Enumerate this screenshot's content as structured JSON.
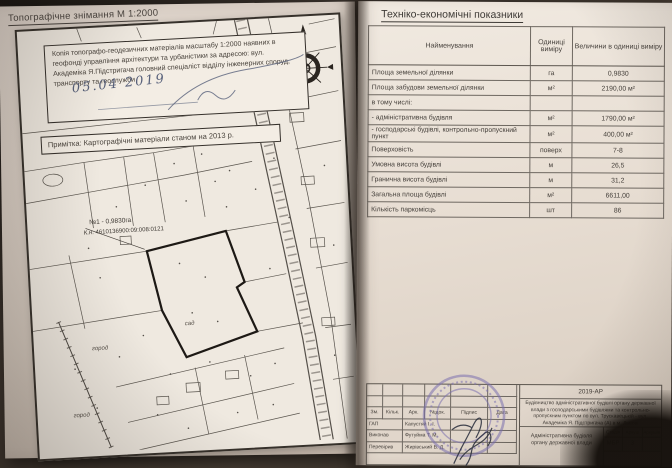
{
  "left_page": {
    "title": "Топографічне знімання М 1:2000",
    "certification": {
      "text": "Копія топографо-геодезичних матеріалів масштабу 1:2000 наявних в геофонді управління архітектури та урбаністики за адресою: вул. Академіка Я.Підстригача головний спеціаліст відділу інженерних споруд, транспорту та геослужби",
      "handwritten_date": "05.04 2019"
    },
    "note": "Примітка: Картографічні матеріали станом на 2013 р.",
    "map": {
      "north_label": "ПН",
      "parcel_label": "№1 - 0,9830га",
      "cadastral_label": "К.н. 4610136900:09:008:0121",
      "land_use_labels": [
        "город",
        "город",
        "сад"
      ]
    }
  },
  "right_page": {
    "title": "Техніко-економічні показники",
    "table": {
      "headers": [
        "Найменування",
        "Одиниці виміру",
        "Величини в одиниці виміру"
      ],
      "rows": [
        [
          "Площа земельної ділянки",
          "га",
          "0,9830"
        ],
        [
          "Площа забудови земельної ділянки",
          "м²",
          "2190,00 м²"
        ],
        [
          "в тому числі:",
          "",
          ""
        ],
        [
          "- адміністративна будівля",
          "м²",
          "1790,00 м²"
        ],
        [
          "- господарські будівлі, контрольно-пропускний пункт",
          "м²",
          "400,00 м²"
        ],
        [
          "Поверховість",
          "поверх",
          "7-8"
        ],
        [
          "Умовна висота будівлі",
          "м",
          "26,5"
        ],
        [
          "Гранична висота будівлі",
          "м",
          "31,2"
        ],
        [
          "Загальна площа будівлі",
          "м²",
          "6611,00"
        ],
        [
          "Кількість паркомісць",
          "шт",
          "86"
        ]
      ]
    },
    "title_block": {
      "project_code": "2019-АР",
      "project_name": "Будівництво адміністративної будівлі органу державної влади з господарськими будівлями та контрольно-пропускним пунктом по вул. Трускавецькій - вул. Академіка Я. Підстригача (А) в м. Львові",
      "columns": [
        "Зм.",
        "Кільк.",
        "Арк.",
        "№док.",
        "Підпис",
        "Дата"
      ],
      "roles": [
        {
          "role": "ГАП",
          "name": "Капустяй І. І."
        },
        {
          "role": "Виконав",
          "name": "Футуйма Т. М."
        },
        {
          "role": "Перевірив",
          "name": "Жирівський В. Д."
        }
      ],
      "drawing_title": "Адміністративна будівля органу державної влади",
      "stage_label": "Стадія",
      "sheet_label": "Аркуш",
      "sheets_label": "Аркушів",
      "stage_value": "МБР",
      "sheet_value": "3"
    }
  }
}
